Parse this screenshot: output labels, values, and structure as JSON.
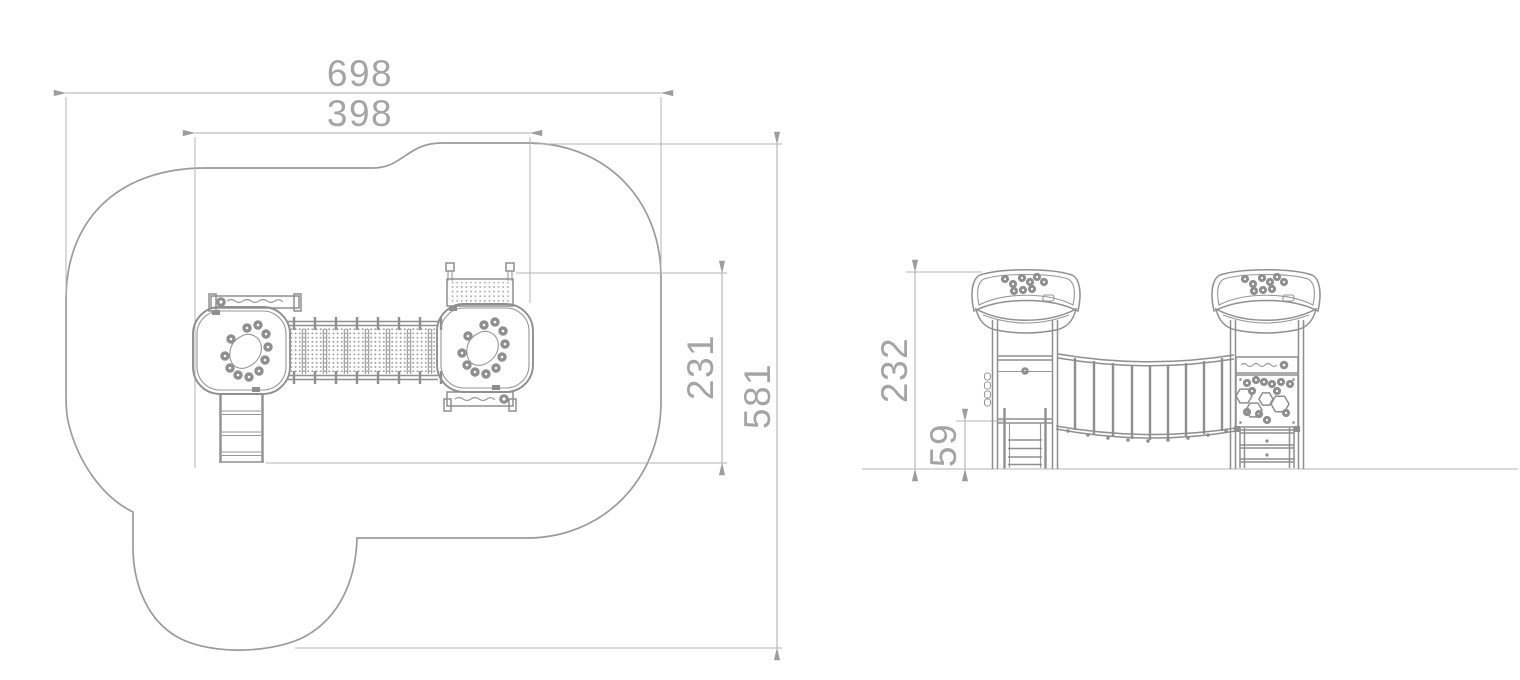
{
  "drawing": {
    "plan_view": {
      "width_total": "698",
      "width_inner": "398",
      "depth_inner": "231",
      "depth_total": "581"
    },
    "side_view": {
      "height_total": "232",
      "height_platform": "59"
    },
    "colors": {
      "structure_line": "#8f8f8f",
      "outline": "#9b9b9b",
      "dimension_line": "#ababab",
      "label_text": "#a4a4a4",
      "ground_line": "#cdcdcd",
      "background": "#ffffff"
    }
  }
}
